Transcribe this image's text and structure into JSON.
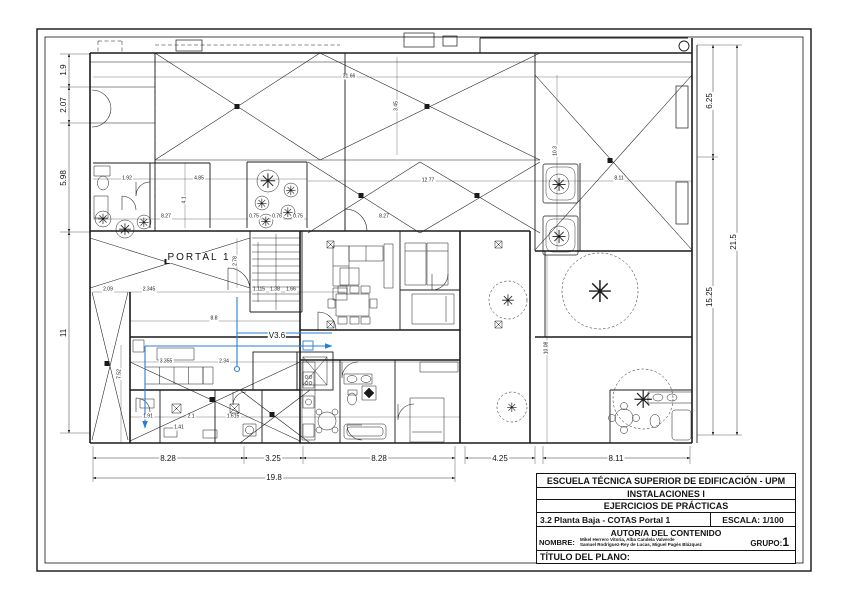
{
  "title_block": {
    "school": "ESCUELA TÉCNICA SUPERIOR DE EDIFICACIÓN - UPM",
    "course": "INSTALACIONES I",
    "exercise": "EJERCICIOS DE PRÁCTICAS",
    "sheet_title": "3.2 Planta Baja - COTAS Portal 1",
    "scale_label": "ESCALA: 1/100",
    "authorship_header": "AUTOR/A DEL CONTENIDO",
    "name_label": "NOMBRE:",
    "names_line1": "Mikel Herrero Vitoria, Alba Candela Valverde",
    "names_line2": "Samuel Rodríguez-Rey de Lucas, Miguel Pagés Blázquez",
    "group_label": "GRUPO:",
    "group_value": "1",
    "plan_title_label": "TÍTULO DEL PLANO:"
  },
  "plan": {
    "room_labels": [
      {
        "t": "PORTAL 1",
        "x": 199,
        "y": 258,
        "cls": "room",
        "name": "portal-label"
      },
      {
        "t": "V3.6",
        "x": 277,
        "y": 336,
        "cls": "win",
        "name": "window-label-v36"
      }
    ],
    "dimensions_major": [
      {
        "t": "1.9",
        "x": 64,
        "y": 70,
        "r": -90
      },
      {
        "t": "2.07",
        "x": 64,
        "y": 105,
        "r": -90
      },
      {
        "t": "5.98",
        "x": 64,
        "y": 178,
        "r": -90
      },
      {
        "t": "11",
        "x": 64,
        "y": 333,
        "r": -90
      },
      {
        "t": "6.25",
        "x": 710,
        "y": 101,
        "r": -90
      },
      {
        "t": "15.25",
        "x": 710,
        "y": 297,
        "r": -90
      },
      {
        "t": "21.5",
        "x": 734,
        "y": 242,
        "r": -90
      },
      {
        "t": "8.28",
        "x": 168,
        "y": 459,
        "r": 0
      },
      {
        "t": "3.25",
        "x": 273,
        "y": 459,
        "r": 0
      },
      {
        "t": "8.28",
        "x": 379,
        "y": 459,
        "r": 0
      },
      {
        "t": "4.25",
        "x": 500,
        "y": 459,
        "r": 0
      },
      {
        "t": "8.11",
        "x": 616,
        "y": 459,
        "r": 0
      },
      {
        "t": "19.8",
        "x": 274,
        "y": 478,
        "r": 0
      }
    ],
    "dimensions_minor": [
      {
        "t": "31.66",
        "x": 349,
        "y": 77,
        "r": 0
      },
      {
        "t": "3.45",
        "x": 397,
        "y": 106,
        "r": -90
      },
      {
        "t": "12.77",
        "x": 428,
        "y": 181,
        "r": 0
      },
      {
        "t": "8.27",
        "x": 384,
        "y": 217,
        "r": 0
      },
      {
        "t": "8.27",
        "x": 166,
        "y": 217,
        "r": 0
      },
      {
        "t": "4.85",
        "x": 199,
        "y": 179,
        "r": 0
      },
      {
        "t": "4.1",
        "x": 185,
        "y": 200,
        "r": -90
      },
      {
        "t": "1.92",
        "x": 127,
        "y": 179,
        "r": 0
      },
      {
        "t": "8.11",
        "x": 619,
        "y": 179,
        "r": 0
      },
      {
        "t": "10.3",
        "x": 556,
        "y": 151,
        "r": -90
      },
      {
        "t": "10.08",
        "x": 547,
        "y": 348,
        "r": -90
      },
      {
        "t": "2.09",
        "x": 108,
        "y": 290,
        "r": 0
      },
      {
        "t": "2.345",
        "x": 149,
        "y": 290,
        "r": 0
      },
      {
        "t": "2.78",
        "x": 236,
        "y": 261,
        "r": -90
      },
      {
        "t": "1.115",
        "x": 259,
        "y": 290,
        "r": 0
      },
      {
        "t": "1.38",
        "x": 275,
        "y": 290,
        "r": 0
      },
      {
        "t": "1.66",
        "x": 291,
        "y": 290,
        "r": 0
      },
      {
        "t": "8.8",
        "x": 214,
        "y": 319,
        "r": 0
      },
      {
        "t": "3.355",
        "x": 166,
        "y": 362,
        "r": 0
      },
      {
        "t": "2.34",
        "x": 224,
        "y": 362,
        "r": 0
      },
      {
        "t": "7.52",
        "x": 120,
        "y": 374,
        "r": -90
      },
      {
        "t": "1.91",
        "x": 148,
        "y": 417,
        "r": 0
      },
      {
        "t": "2.1",
        "x": 191,
        "y": 417,
        "r": 0
      },
      {
        "t": "1.615",
        "x": 233,
        "y": 417,
        "r": 0
      },
      {
        "t": "1.41",
        "x": 179,
        "y": 428,
        "r": 0
      },
      {
        "t": "0.75",
        "x": 254,
        "y": 217,
        "r": 0
      },
      {
        "t": "0.76",
        "x": 277,
        "y": 217,
        "r": 0
      },
      {
        "t": "0.75",
        "x": 298,
        "y": 217,
        "r": 0
      }
    ]
  },
  "symbols": {
    "tree_glyph": "✳"
  },
  "colors": {
    "line": "#1b1b1b",
    "pipe": "#2a7fd4"
  }
}
